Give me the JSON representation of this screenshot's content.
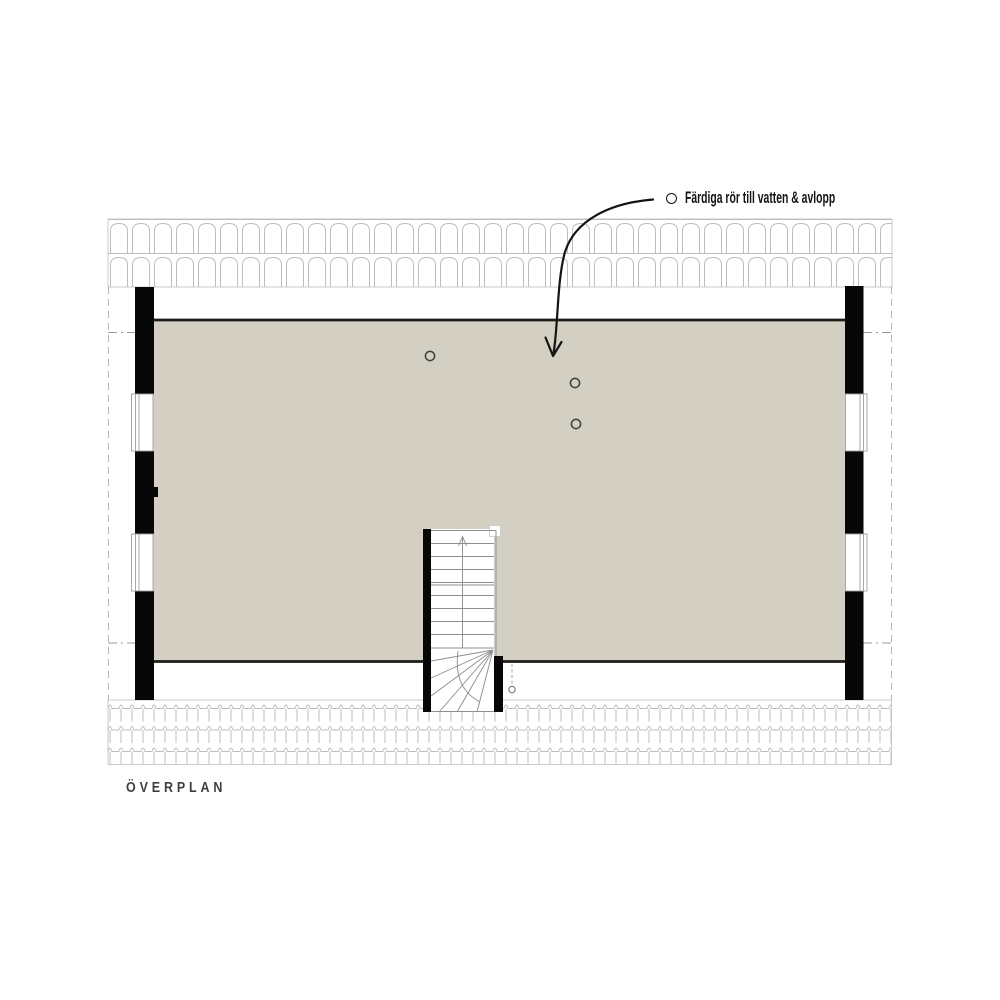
{
  "page": {
    "background_color": "#ffffff"
  },
  "plan": {
    "name_label": "ÖVERPLAN",
    "annotation": {
      "text": "Färdiga rör till vatten & avlopp",
      "marker_shape": "circle",
      "pipe_marker_count": 3
    },
    "colors": {
      "floor_fill": "#d3cfc2",
      "wall_black": "#070707",
      "floor_edge": "#1e1d1a",
      "tile_line": "#bdbdbd",
      "dash_line": "#b5b5b5",
      "stair_line": "#8f8f8f",
      "annotation_text": "#141414",
      "plan_label_text": "#3f3f3f"
    }
  }
}
